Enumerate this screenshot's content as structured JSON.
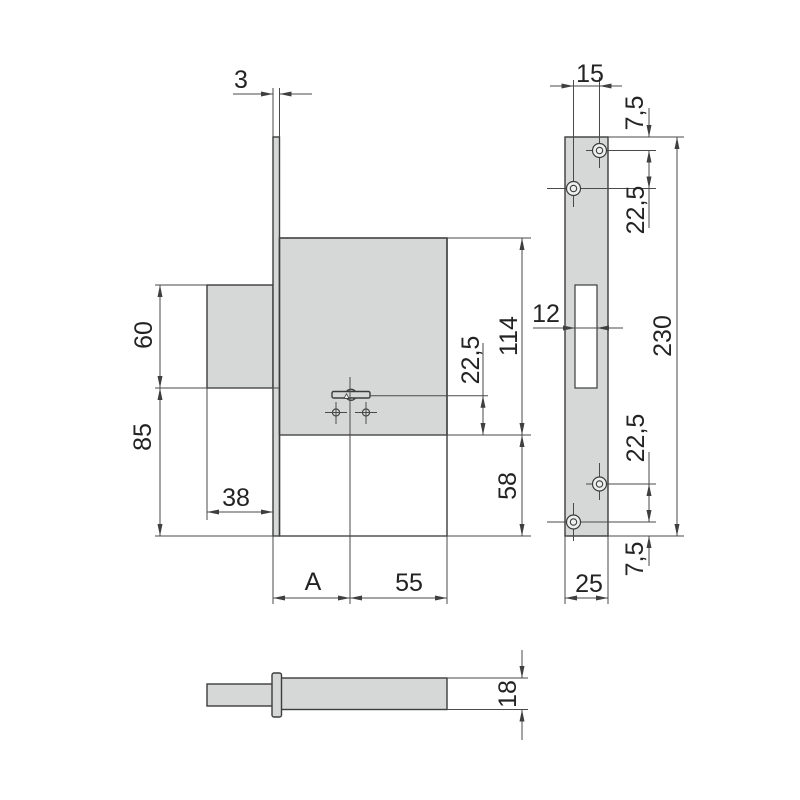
{
  "colors": {
    "background": "#ffffff",
    "part_fill": "#d6d8d8",
    "line": "#3c3c3c",
    "dim_line": "#4a4a4a",
    "text": "#232323"
  },
  "front_view": {
    "faceplate_thickness": "3",
    "block_height": "60",
    "lower_height": "85",
    "block_depth": "38",
    "backset_label": "A",
    "key_to_case_edge": "55",
    "case_height": "114",
    "key_axis_offset": "22,5",
    "bottom_margin": "58"
  },
  "faceplate_view": {
    "hole_x_offset": "15",
    "top_hole_margin": "7,5",
    "upper_hole_pitch": "22,5",
    "slot_width": "12",
    "plate_length": "230",
    "lower_hole_pitch": "22,5",
    "bottom_hole_margin": "7,5",
    "plate_width": "25"
  },
  "bolt_view": {
    "bolt_thickness": "18"
  }
}
